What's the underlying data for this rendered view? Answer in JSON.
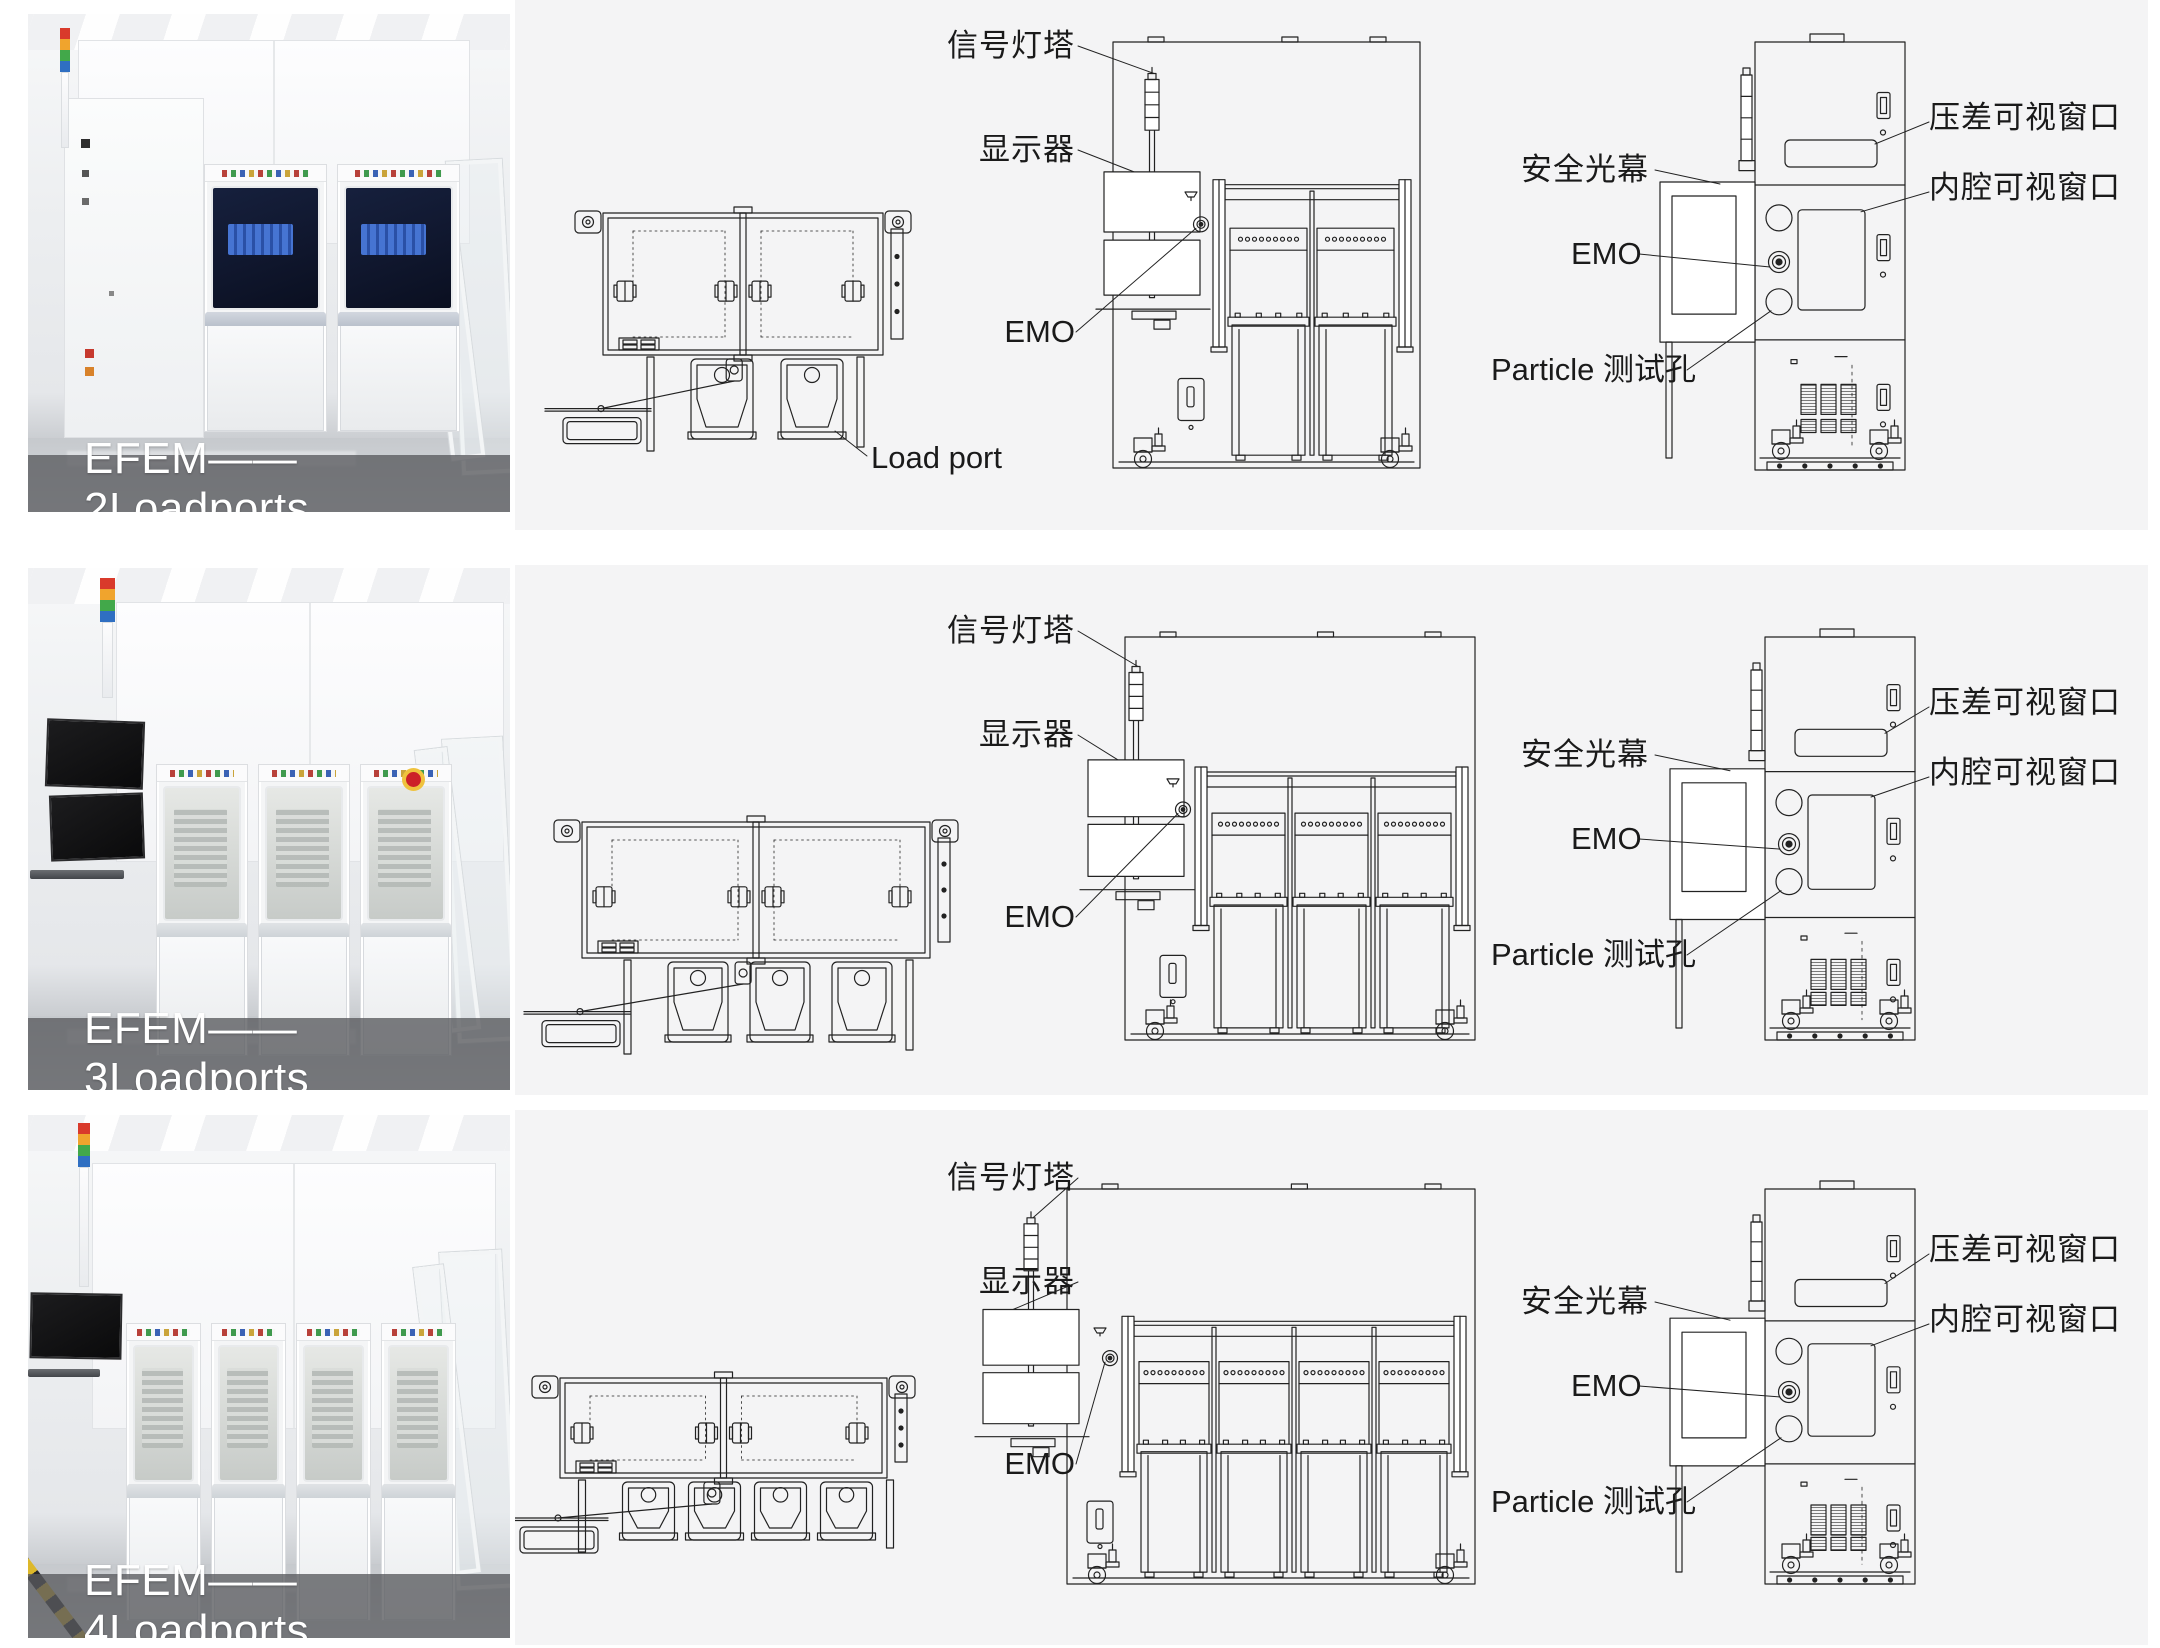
{
  "rows": [
    {
      "caption": "EFEM——2Loadports",
      "loadports": 2,
      "labels": {
        "signal_tower": "信号灯塔",
        "display": "显示器",
        "emo_front": "EMO",
        "load_port": "Load port",
        "safety_light_curtain": "安全光幕",
        "emo_side": "EMO",
        "particle_test_hole": "Particle 测试孔",
        "pressure_window": "压差可视窗口",
        "cavity_window": "内腔可视窗口"
      }
    },
    {
      "caption": "EFEM——3Loadports",
      "loadports": 3,
      "labels": {
        "signal_tower": "信号灯塔",
        "display": "显示器",
        "emo_front": "EMO",
        "safety_light_curtain": "安全光幕",
        "emo_side": "EMO",
        "particle_test_hole": "Particle 测试孔",
        "pressure_window": "压差可视窗口",
        "cavity_window": "内腔可视窗口"
      }
    },
    {
      "caption": "EFEM——4Loadports",
      "loadports": 4,
      "labels": {
        "signal_tower": "信号灯塔",
        "display": "显示器",
        "emo_front": "EMO",
        "safety_light_curtain": "安全光幕",
        "emo_side": "EMO",
        "particle_test_hole": "Particle 测试孔",
        "pressure_window": "压差可视窗口",
        "cavity_window": "内腔可视窗口"
      }
    }
  ],
  "colors": {
    "panel_bg": "#f4f4f5",
    "line": "#222222",
    "caption_bg": "rgba(88,90,94,0.78)",
    "caption_text": "#ffffff",
    "tower_red": "#d93a2b",
    "tower_yellow": "#f0a42d",
    "tower_green": "#42a84a",
    "tower_blue": "#2f6fc2",
    "window_navy": "#16203d",
    "emo_red": "#cc2128"
  }
}
